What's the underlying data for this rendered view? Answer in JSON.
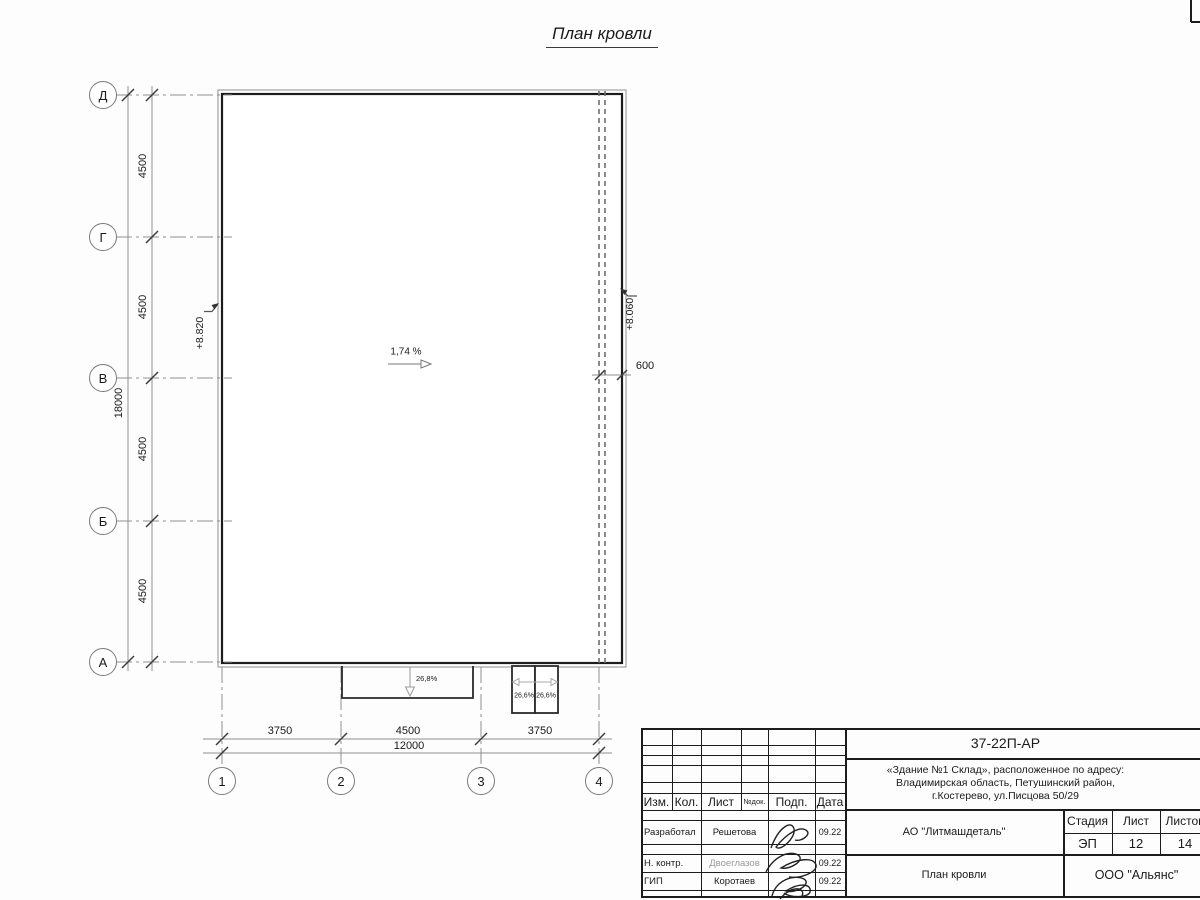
{
  "sheet_title": "План кровли",
  "plan": {
    "slope_label": "1,74 %",
    "elevation_left": "+8.820",
    "elevation_right": "+8.060",
    "parapet_offset": "600",
    "canopy_slope": "26,8%",
    "ramp_slope_left": "26,6%",
    "ramp_slope_right": "26,6%",
    "row_axes": [
      "Д",
      "Г",
      "В",
      "Б",
      "А"
    ],
    "col_axes": [
      "1",
      "2",
      "3",
      "4"
    ],
    "row_spacings": [
      "4500",
      "4500",
      "4500",
      "4500"
    ],
    "row_total": "18000",
    "col_spacings": [
      "3750",
      "4500",
      "3750"
    ],
    "col_total": "12000"
  },
  "title_block": {
    "doc_number": "37-22П-АР",
    "project_lines": [
      "«Здание №1 Склад», расположенное по адресу:",
      "Владимирская область, Петушинский район,",
      "г.Костерево, ул.Писцова 50/29"
    ],
    "client": "АО \"Литмашдеталь\"",
    "sheet_name": "План кровли",
    "contractor": "ООО \"Альянс\"",
    "stage_label": "Стадия",
    "sheet_label": "Лист",
    "sheets_label": "Листов",
    "stage": "ЭП",
    "sheet_no": "12",
    "sheets_total": "14",
    "rev_headers": [
      "Изм.",
      "Кол.",
      "Лист",
      "№док.",
      "Подп.",
      "Дата"
    ],
    "signoff_rows": [
      {
        "role": "Разработал",
        "name": "Решетова",
        "date": "09.22"
      },
      {
        "role": "Н. контр.",
        "name": "Двоеглазов",
        "date": "09.22"
      },
      {
        "role": "ГИП",
        "name": "Коротаев",
        "date": "09.22"
      }
    ]
  }
}
